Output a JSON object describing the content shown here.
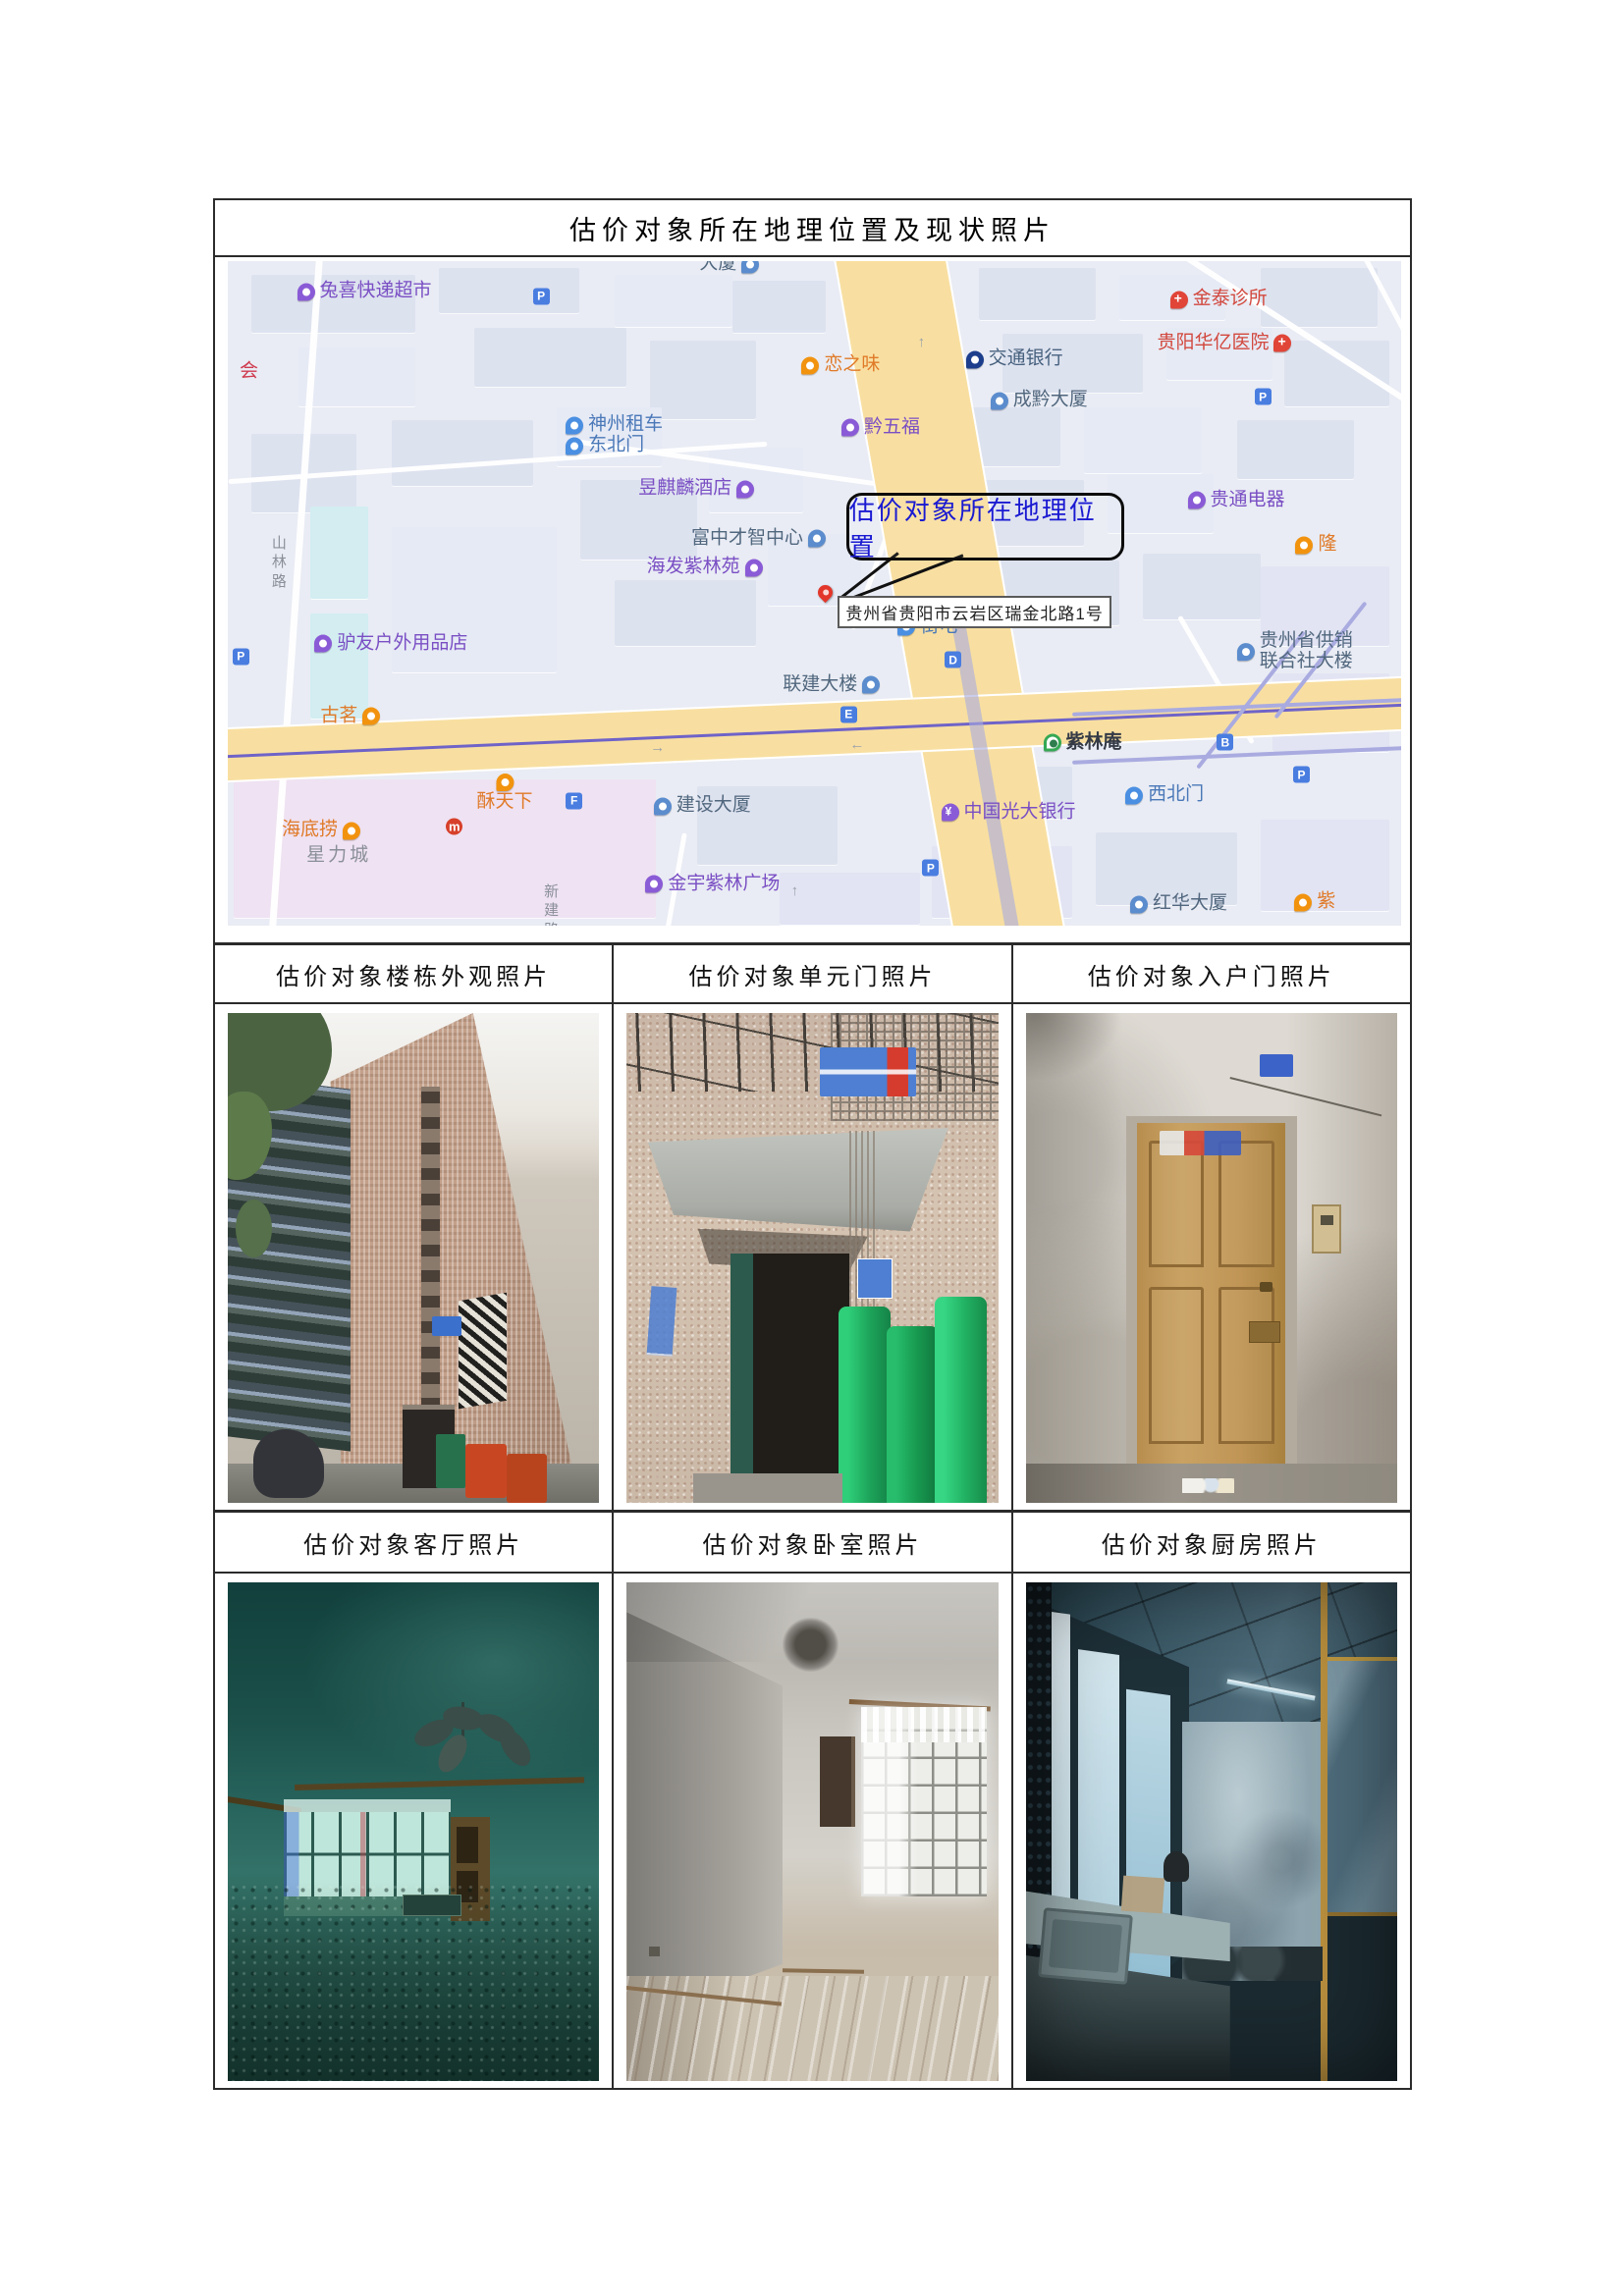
{
  "page": {
    "title": "估价对象所在地理位置及现状照片"
  },
  "captions": [
    "估价对象楼栋外观照片",
    "估价对象单元门照片",
    "估价对象入户门照片",
    "估价对象客厅照片",
    "估价对象卧室照片",
    "估价对象厨房照片"
  ],
  "map": {
    "callout": "估价对象所在地理位置",
    "pin_address": "贵州省贵阳市云岩区瑞金北路1号",
    "road_labels": [
      "山林路",
      "新建路"
    ],
    "badges": [
      "P",
      "P",
      "P",
      "P",
      "P",
      "D",
      "E",
      "F",
      "B",
      "m"
    ],
    "arrows": [
      "↑",
      "←",
      "↑",
      "→"
    ],
    "pois": [
      {
        "label": "兔喜快递超市"
      },
      {
        "label": "恋之味"
      },
      {
        "label": "交通银行"
      },
      {
        "label": "金泰诊所"
      },
      {
        "label": "贵阳华亿医院"
      },
      {
        "label": "成黔大厦"
      },
      {
        "label": "黔五福"
      },
      {
        "label": "神州租车"
      },
      {
        "label": "东北门"
      },
      {
        "label": "昱麒麟酒店"
      },
      {
        "label": "富中才智中心"
      },
      {
        "label": "海发紫林苑"
      },
      {
        "label": "贵通电器"
      },
      {
        "label": "驴友户外用品店"
      },
      {
        "label": "古茗"
      },
      {
        "label": "海底捞"
      },
      {
        "label": "星力城"
      },
      {
        "label": "酥天下"
      },
      {
        "label": "建设大厦"
      },
      {
        "label": "金宇紫林广场"
      },
      {
        "label": "街电"
      },
      {
        "label": "联建大楼"
      },
      {
        "label": "紫林庵"
      },
      {
        "label": "西北门"
      },
      {
        "label": "中国光大银行"
      },
      {
        "label": "红华大厦"
      },
      {
        "label": "贵州省供销联合社大楼"
      },
      {
        "label": "隆"
      },
      {
        "label": "紫"
      },
      {
        "label": "会"
      },
      {
        "label": "大厦"
      }
    ]
  },
  "colors": {
    "callout_text": "#1a1ad2",
    "poi_purple": "#8a5bd6",
    "poi_orange": "#f2930f",
    "poi_blue": "#4a8fe2",
    "poi_navy": "#1c3e8c",
    "poi_red": "#e04538",
    "metro_green": "#35a854",
    "parking_blue": "#4a7de0",
    "road_yellow": "#f8dfa1",
    "map_background": "#e9ecf4",
    "table_border": "#2b2b2b"
  }
}
